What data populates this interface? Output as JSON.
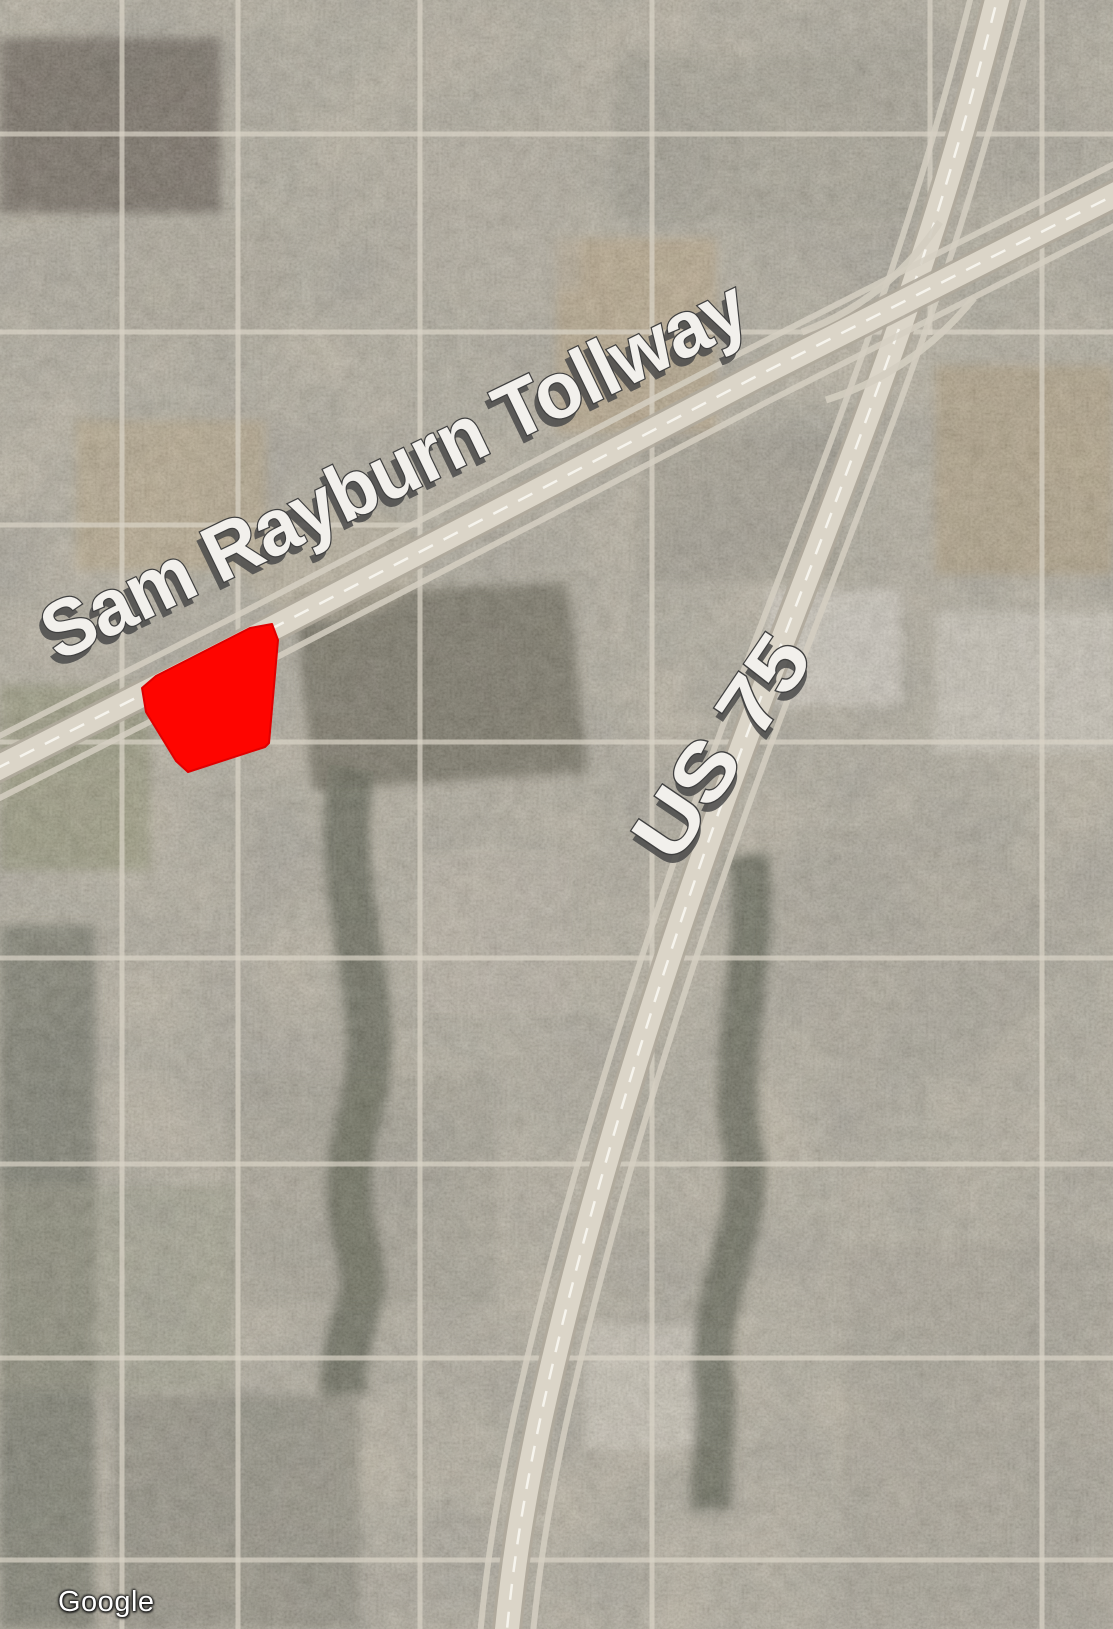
{
  "map": {
    "provider": "Google",
    "view_type": "satellite",
    "watermark": {
      "text": "Google"
    },
    "labels": {
      "tollway": {
        "text": "Sam Rayburn Tollway",
        "fill": "#f2f0ec",
        "shadow": "#4a4a4a"
      },
      "us75": {
        "text": "US 75",
        "fill": "#f2f0ec",
        "shadow": "#4a4a4a"
      }
    },
    "parcel": {
      "description": "highlighted site outline south of Sam Rayburn Tollway",
      "color": "#fe0500",
      "points": "272,624 278,640 269,743 265,747 188,772 176,761 146,712 142,688 156,676 250,628"
    },
    "highways": {
      "sam_rayburn": {
        "name": "Sam Rayburn Tollway",
        "path": "M -30,782 L 240,645 L 520,500 L 755,377 L 1140,182"
      },
      "us75": {
        "name": "US 75",
        "path": "M 1002,-20 C 955,170 912,295 868,415 C 800,600 755,705 695,880 C 628,1075 575,1260 540,1420 C 520,1515 512,1575 506,1640"
      }
    },
    "palette": {
      "land_base": "#a09a8b",
      "highway_bed": "#dbd5c8",
      "highway_casing": "#b0aa9c",
      "lane_dash": "#f6f4ed",
      "minor_road": "#d9d3c6",
      "woodland": "#4b4d3a",
      "field_tan": "#b29a70",
      "field_dark": "#51493b"
    }
  }
}
